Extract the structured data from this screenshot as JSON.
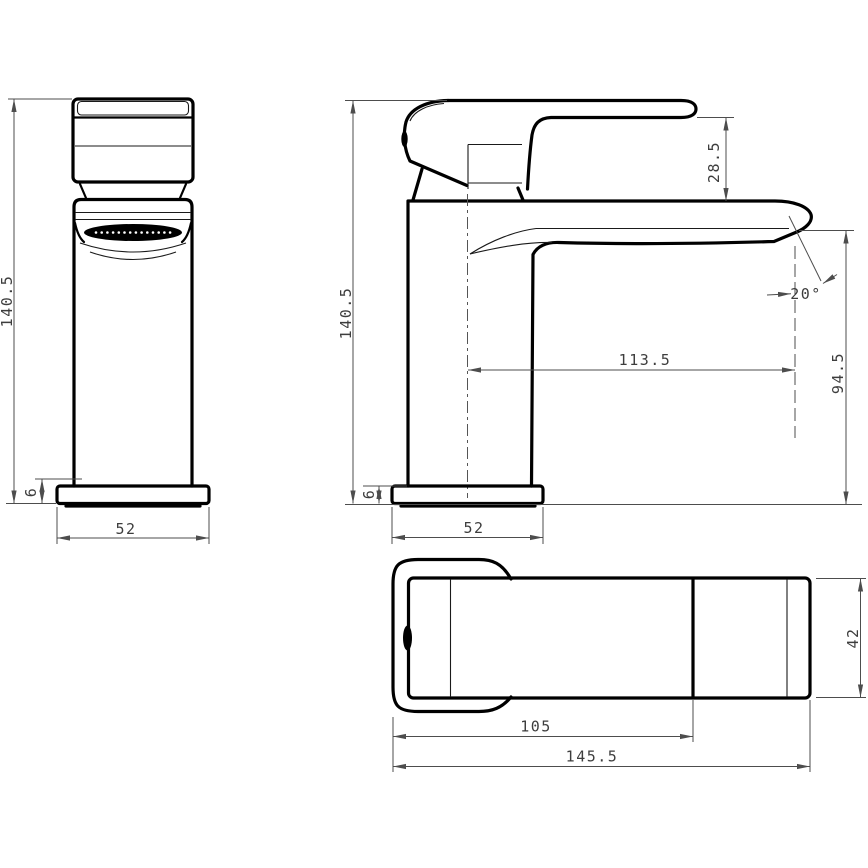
{
  "drawing": {
    "dimensions": {
      "front_view": {
        "overall_height": "140.5",
        "base_thickness": "6",
        "base_width": "52"
      },
      "side_view": {
        "overall_height": "140.5",
        "base_thickness": "6",
        "base_depth": "52",
        "handle_to_spout_gap": "28.5",
        "spout_reach": "113.5",
        "outlet_height": "94.5",
        "outlet_angle": "20°"
      },
      "top_view": {
        "body_to_grip_length": "105",
        "overall_length": "145.5",
        "handle_width": "42"
      }
    },
    "colors": {
      "background": "#ffffff",
      "outline": "#000000",
      "dimension": "#4d4d4d",
      "aerator_fill": "#000000"
    }
  }
}
